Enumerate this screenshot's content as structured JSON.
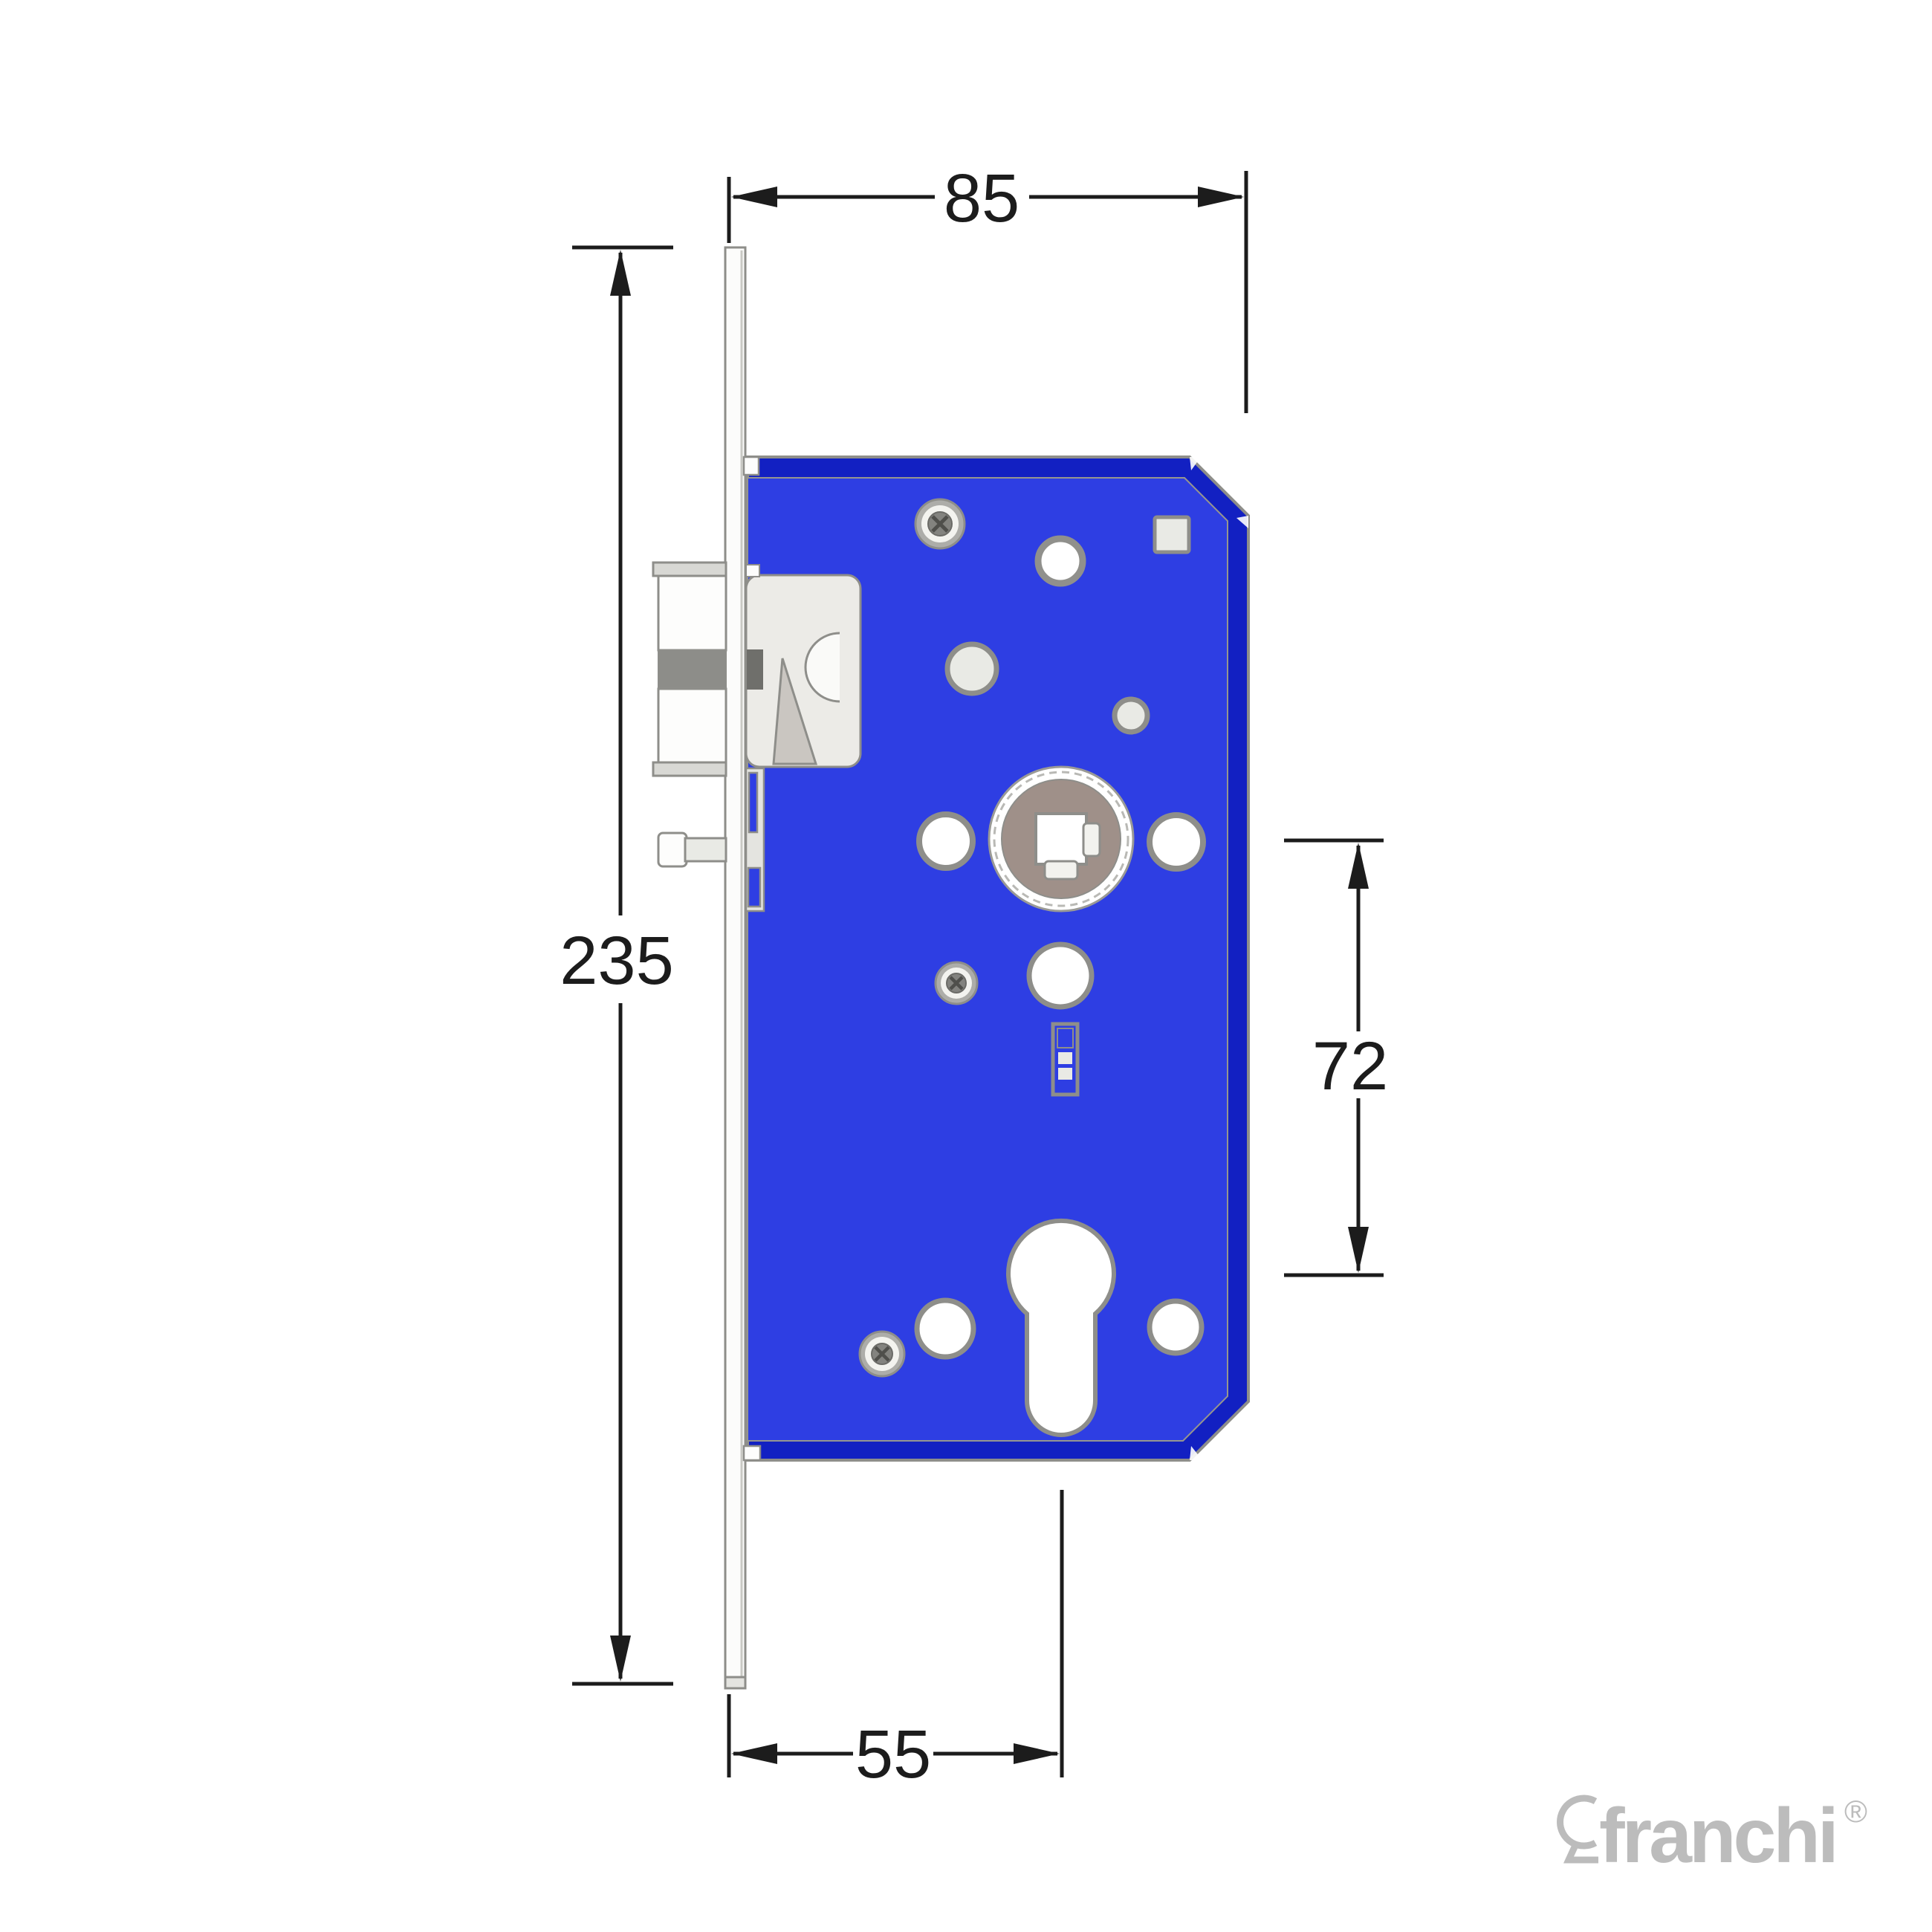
{
  "dimensions": {
    "case_depth": {
      "value": "85",
      "position": "top",
      "orientation": "horizontal"
    },
    "faceplate_height": {
      "value": "235",
      "position": "left",
      "orientation": "vertical"
    },
    "centres": {
      "value": "72",
      "position": "right",
      "orientation": "vertical"
    },
    "backset": {
      "value": "55",
      "position": "bottom",
      "orientation": "horizontal"
    }
  },
  "logo": {
    "text": "franchi",
    "registered": "®",
    "icon": "keyhole-icon"
  },
  "colors": {
    "body-blue": "#2e3ee3",
    "edge-dark-blue": "#1220c2",
    "outline-gray": "#8e8e8a",
    "metal-light": "#e9eae5",
    "metal-white": "#ffffff",
    "hub-taupe": "#9f9089",
    "dimension-black": "#1c1c1c",
    "logo-gray": "#bcbcbc"
  }
}
